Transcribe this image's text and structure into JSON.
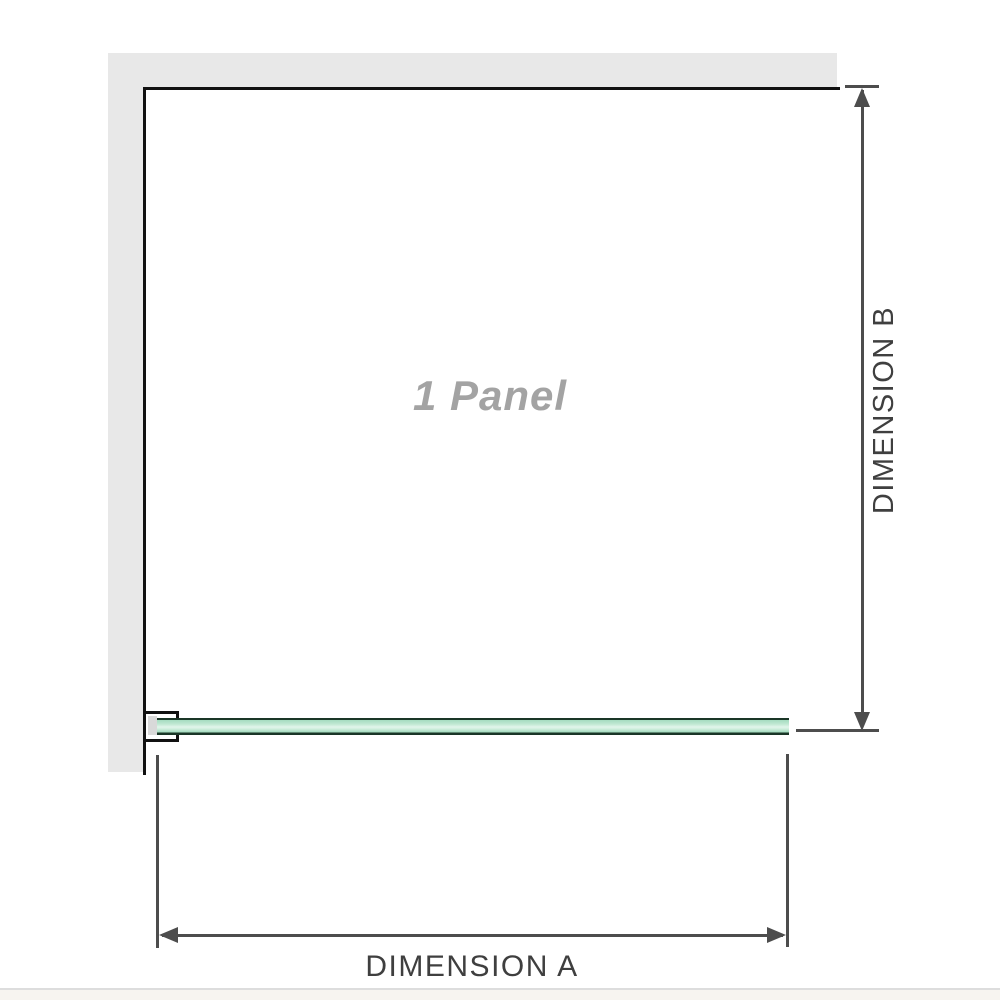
{
  "diagram": {
    "panel_label": "1 Panel",
    "dimension_a_label": "DIMENSION A",
    "dimension_b_label": "DIMENSION B",
    "colors": {
      "wall": "#e8e8e8",
      "panel_border": "#111111",
      "dimension_line": "#4d4d4d",
      "dimension_text": "#3f3f3f",
      "panel_label_text": "#a3a3a3",
      "glass_green": "#a5dcc0",
      "glass_green_light": "#e2f5eb",
      "glass_edge_dark": "#1a3627",
      "divider": "#dddddd"
    }
  }
}
